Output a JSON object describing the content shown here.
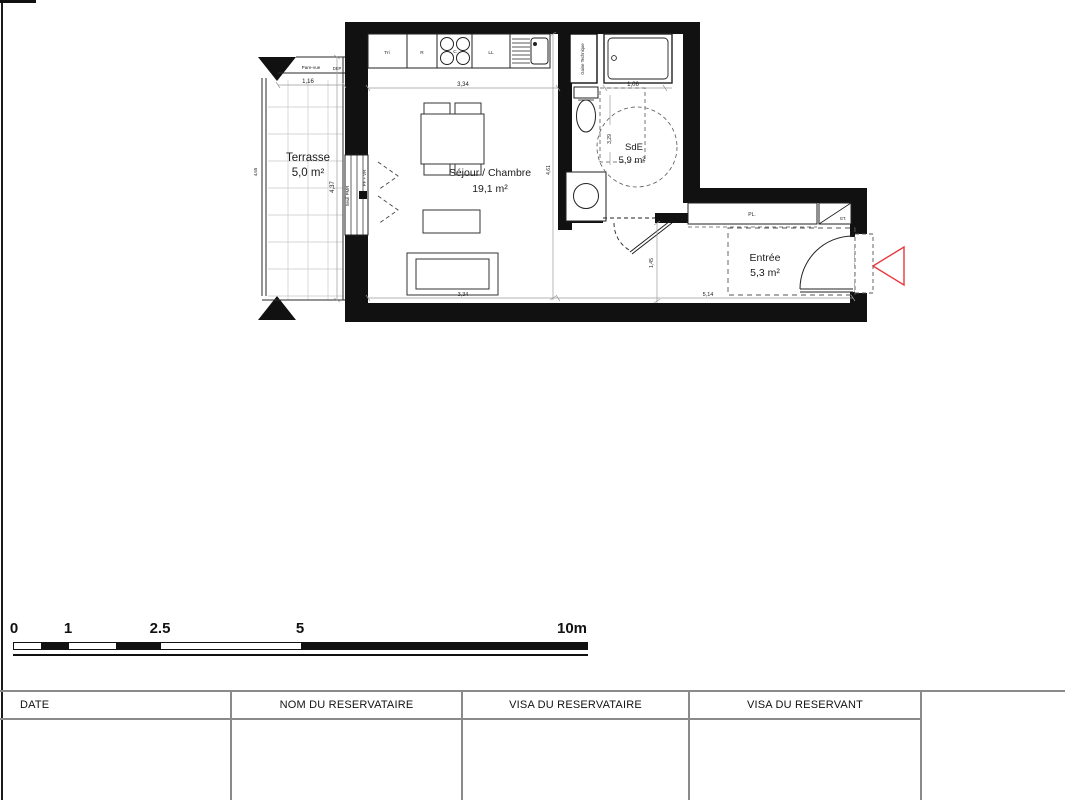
{
  "plan": {
    "rooms": [
      {
        "name": "Terrasse",
        "area": "5,0 m²"
      },
      {
        "name": "Séjour / Chambre",
        "area": "19,1 m²"
      },
      {
        "name": "SdE",
        "area": "5,9 m²"
      },
      {
        "name": "Entrée",
        "area": "5,3 m²"
      }
    ],
    "kitchen": {
      "units": [
        "Tri",
        "R",
        "C",
        "LL"
      ]
    },
    "labels": {
      "gaine_technique": "Gaine Technique",
      "pare_vue": "Pare-vue",
      "dep": "DEP",
      "seuil_pmr": "Seuil PMR",
      "window_type": "PF + VR",
      "closet": "PL.",
      "gt": "GT."
    },
    "dimensions": {
      "pare_vue_width": "1,16",
      "terrasse_length": "4,37",
      "terrasse_rail": "4,65",
      "kitchen_width": "3,34",
      "shower_width": "1,06",
      "sde_length": "3,29",
      "sejour_length": "4,61",
      "entree_depth": "1,45",
      "entree_width": "5,14",
      "sejour_width": "3,34"
    }
  },
  "scalebar": {
    "labels": [
      "0",
      "1",
      "2.5",
      "5",
      "10m"
    ]
  },
  "table": {
    "headers": [
      "DATE",
      "NOM DU RESERVATAIRE",
      "VISA DU RESERVATAIRE",
      "VISA DU RESERVANT"
    ]
  },
  "colors": {
    "wall": "#111111",
    "entry_arrow": "#e8383d",
    "table_line": "#8a8a8a"
  }
}
